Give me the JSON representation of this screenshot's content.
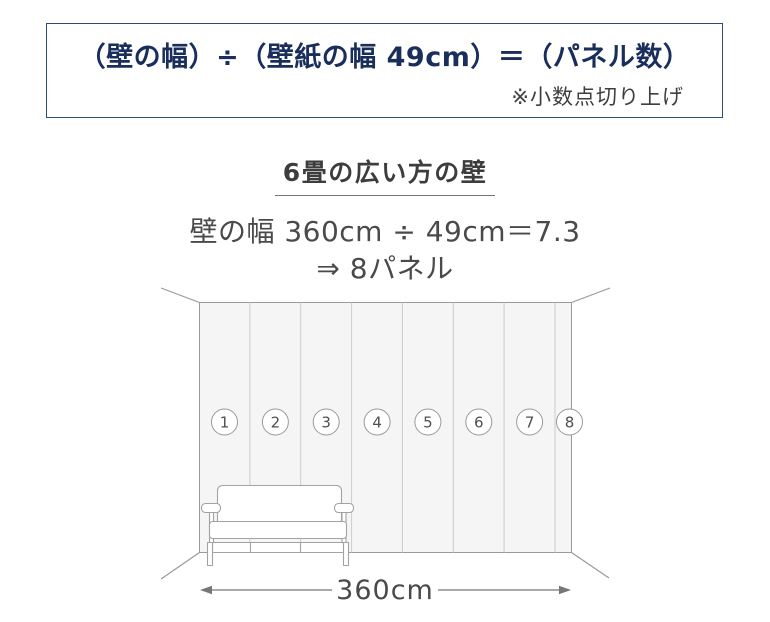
{
  "formula_box": {
    "formula": "（壁の幅）÷（壁紙の幅 49cm）＝（パネル数）",
    "note": "※小数点切り上げ"
  },
  "example": {
    "heading": "6畳の広い方の壁",
    "calculation": "壁の幅 360cm ÷ 49cm＝7.3",
    "result": "⇒ 8パネル"
  },
  "diagram": {
    "panel_numbers": [
      "1",
      "2",
      "3",
      "4",
      "5",
      "6",
      "7",
      "8"
    ],
    "wall_width_label": "360cm"
  },
  "colors": {
    "navy_text": "#1a2e5c",
    "box_border": "#2e4d7e",
    "heading_text": "#3d3d3d",
    "body_text": "#4a4a4a",
    "wall_fill": "#f5f5f5",
    "wall_outline": "#9a9a9a",
    "panel_divider": "#cccccc",
    "sofa_outline": "#a3a3a3",
    "dimension_line": "#777777"
  }
}
